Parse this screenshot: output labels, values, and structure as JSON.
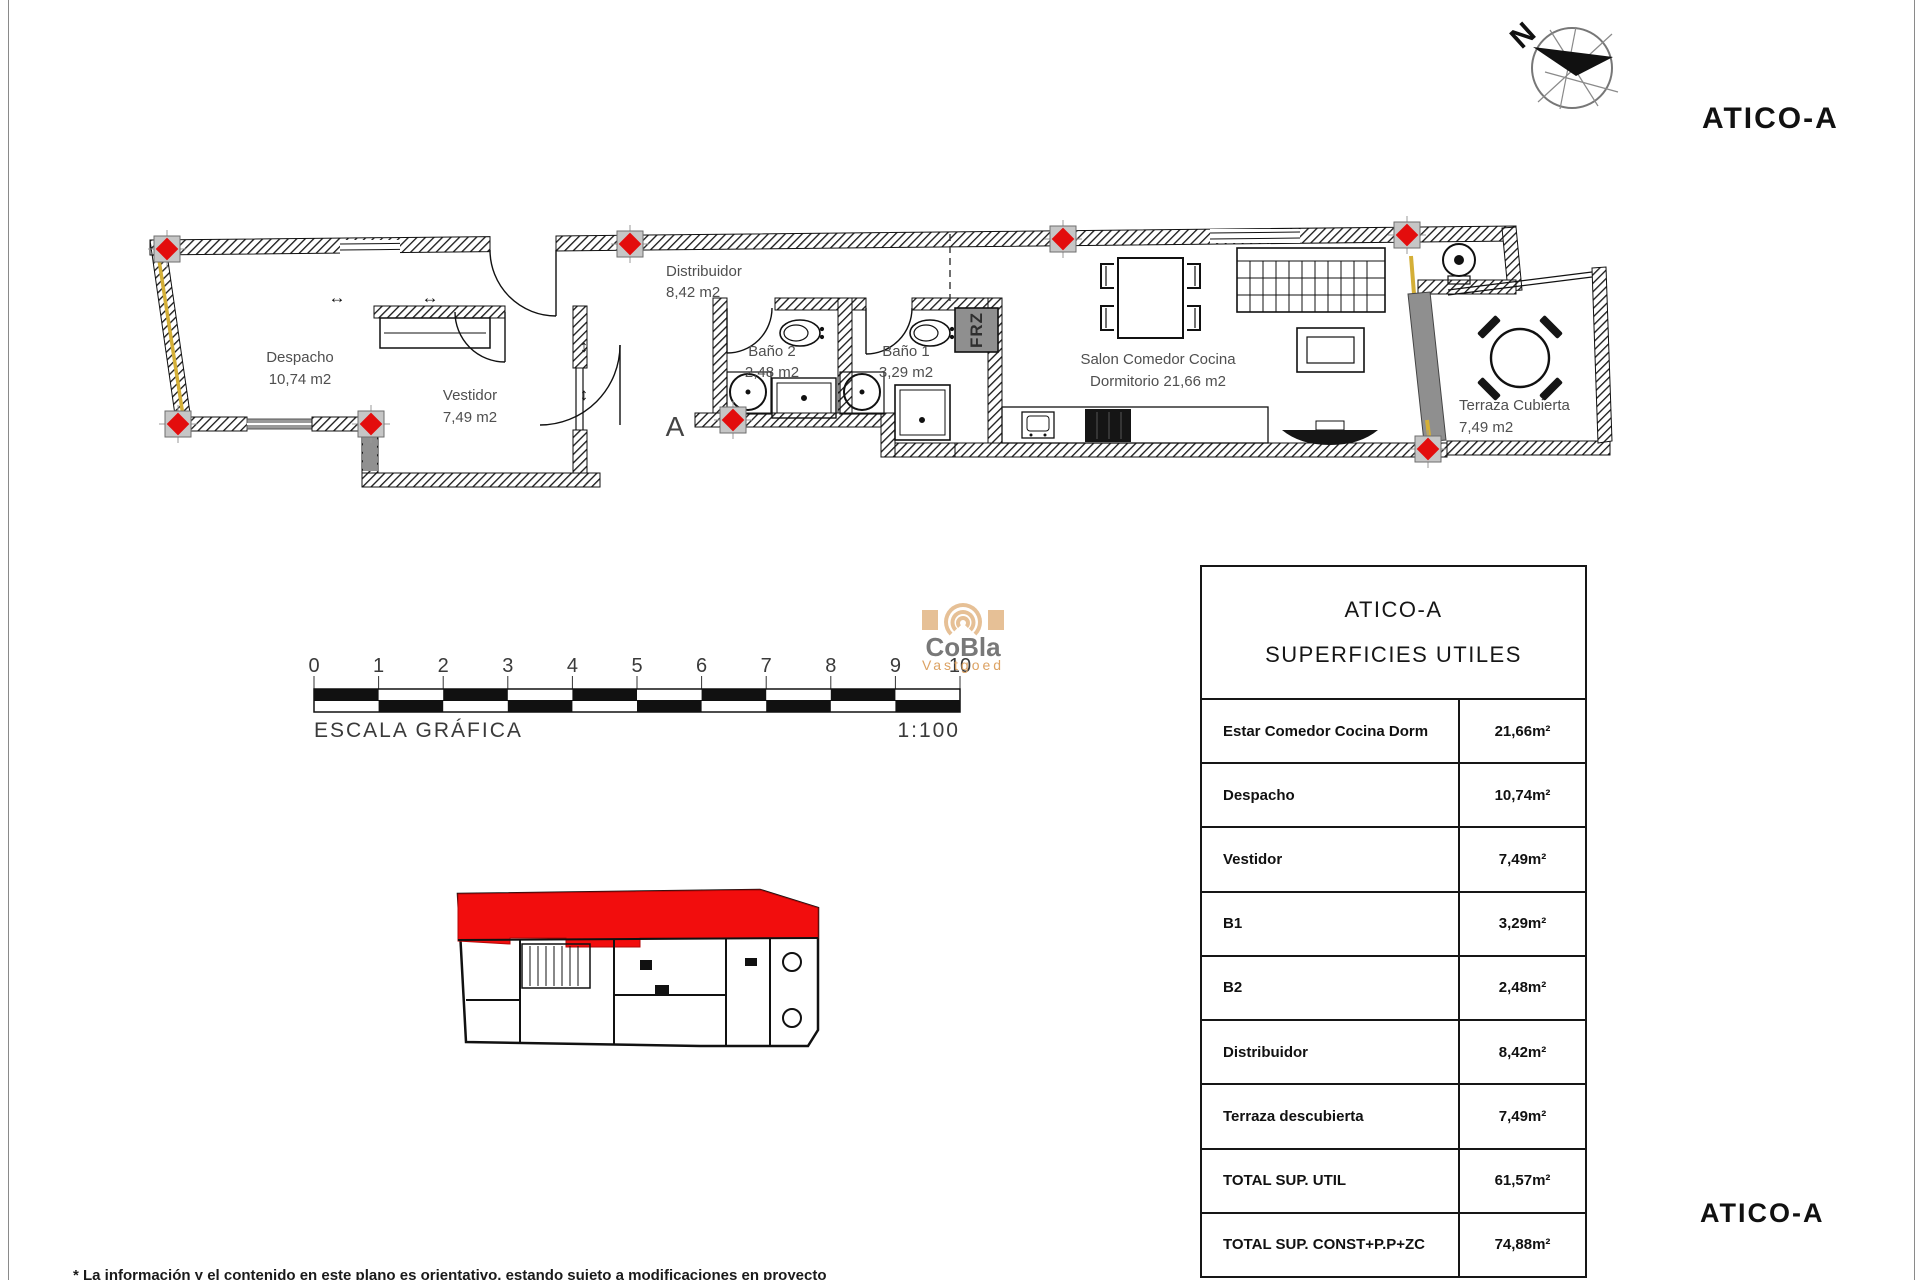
{
  "titles": {
    "top_right": "ATICO-A",
    "bottom_right": "ATICO-A"
  },
  "compass": {
    "north_label": "N"
  },
  "logo": {
    "name": "CoBla",
    "subtitle": "Vastgoed"
  },
  "plan": {
    "rooms": {
      "despacho": {
        "name": "Despacho",
        "area": "10,74 m2"
      },
      "vestidor": {
        "name": "Vestidor",
        "area": "7,49 m2"
      },
      "distribuidor": {
        "name": "Distribuidor",
        "area": "8,42 m2"
      },
      "bano2": {
        "name": "Baño 2",
        "area": "2,48 m2"
      },
      "bano1": {
        "name": "Baño 1",
        "area": "3,29 m2"
      },
      "salon": {
        "line1": "Salon Comedor Cocina",
        "line2": "Dormitorio  21,66 m2"
      },
      "terraza": {
        "name": "Terraza Cubierta",
        "area": "7,49 m2"
      }
    },
    "section_marker": "A",
    "appliance_label": "FRZ"
  },
  "scale": {
    "ticks": [
      "0",
      "1",
      "2",
      "3",
      "4",
      "5",
      "6",
      "7",
      "8",
      "9",
      "10"
    ],
    "label": "ESCALA GRÁFICA",
    "ratio": "1:100"
  },
  "table": {
    "title_line1": "ATICO-A",
    "title_line2": "SUPERFICIES UTILES",
    "rows": [
      {
        "label": "Estar Comedor Cocina Dorm",
        "value": "21,66m²"
      },
      {
        "label": "Despacho",
        "value": "10,74m²"
      },
      {
        "label": "Vestidor",
        "value": "7,49m²"
      },
      {
        "label": "B1",
        "value": "3,29m²"
      },
      {
        "label": "B2",
        "value": "2,48m²"
      },
      {
        "label": "Distribuidor",
        "value": "8,42m²"
      },
      {
        "label": "Terraza descubierta",
        "value": "7,49m²"
      },
      {
        "label": "TOTAL SUP. UTIL",
        "value": "61,57m²"
      },
      {
        "label": "TOTAL SUP. CONST+P.P+ZC",
        "value": "74,88m²"
      }
    ]
  },
  "footer": {
    "disclaimer": "* La información y el contenido en este plano es orientativo, estando sujeto a modificaciones en proyecto"
  }
}
